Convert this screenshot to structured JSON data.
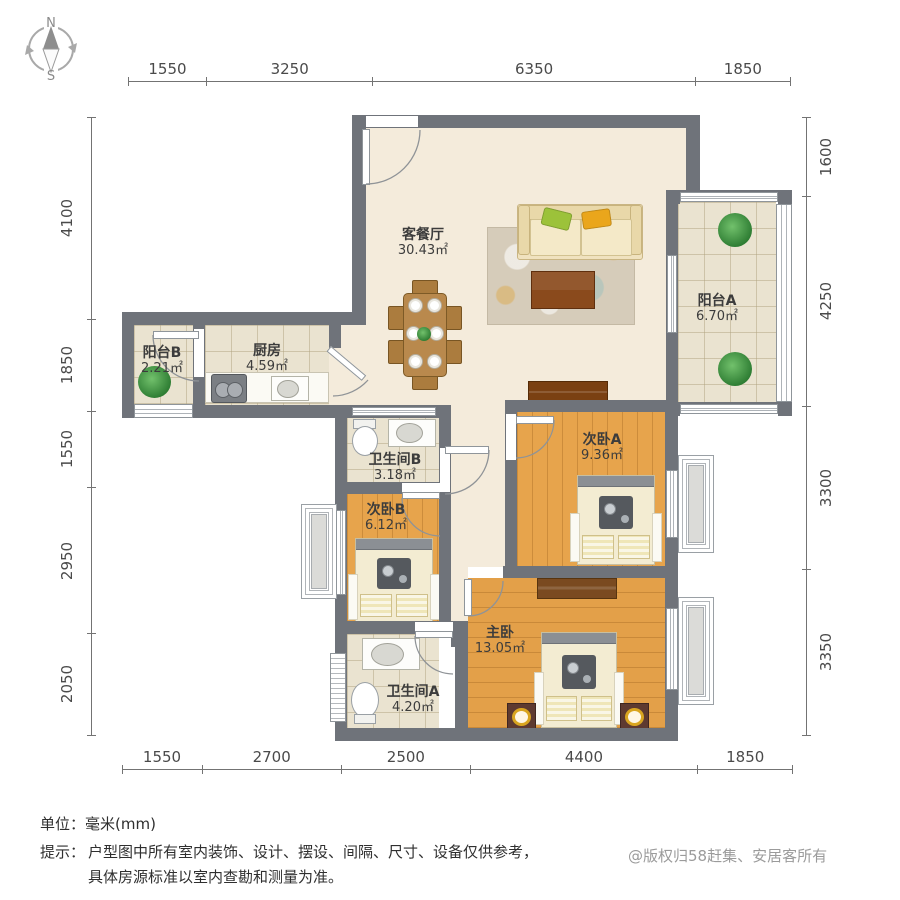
{
  "compass": {
    "north": "N",
    "south": "S"
  },
  "dimensions": {
    "top": [
      1550,
      3250,
      6350,
      1850
    ],
    "bottom": [
      1550,
      2700,
      2500,
      4400,
      1850
    ],
    "left": [
      4100,
      1850,
      1550,
      2950,
      2050
    ],
    "right": [
      1600,
      4250,
      3300,
      3350
    ]
  },
  "rooms": [
    {
      "id": "living",
      "name": "客餐厅",
      "area": "30.43㎡"
    },
    {
      "id": "balcony-a",
      "name": "阳台A",
      "area": "6.70㎡"
    },
    {
      "id": "balcony-b",
      "name": "阳台B",
      "area": "2.21㎡"
    },
    {
      "id": "kitchen",
      "name": "厨房",
      "area": "4.59㎡"
    },
    {
      "id": "bath-b",
      "name": "卫生间B",
      "area": "3.18㎡"
    },
    {
      "id": "bedroom-a",
      "name": "次卧A",
      "area": "9.36㎡"
    },
    {
      "id": "bedroom-b",
      "name": "次卧B",
      "area": "6.12㎡"
    },
    {
      "id": "master",
      "name": "主卧",
      "area": "13.05㎡"
    },
    {
      "id": "bath-a",
      "name": "卫生间A",
      "area": "4.20㎡"
    }
  ],
  "footer": {
    "unit_label": "单位：",
    "unit_value": "毫米(mm)",
    "tip_label": "提示：",
    "tip_line1": "户型图中所有室内装饰、设计、摆设、间隔、尺寸、设备仅供参考，",
    "tip_line2": "具体房源标准以室内查勘和测量为准。",
    "copyright": "@版权归58赶集、安居客所有"
  },
  "colors": {
    "wall": "#6f737a",
    "wood_floor": "#e7a44c",
    "tile_floor": "#eae3d0",
    "living_floor": "#f4ebdb",
    "accent_green_pillow": "#9cc23a",
    "accent_yellow_pillow": "#eaa61c"
  }
}
